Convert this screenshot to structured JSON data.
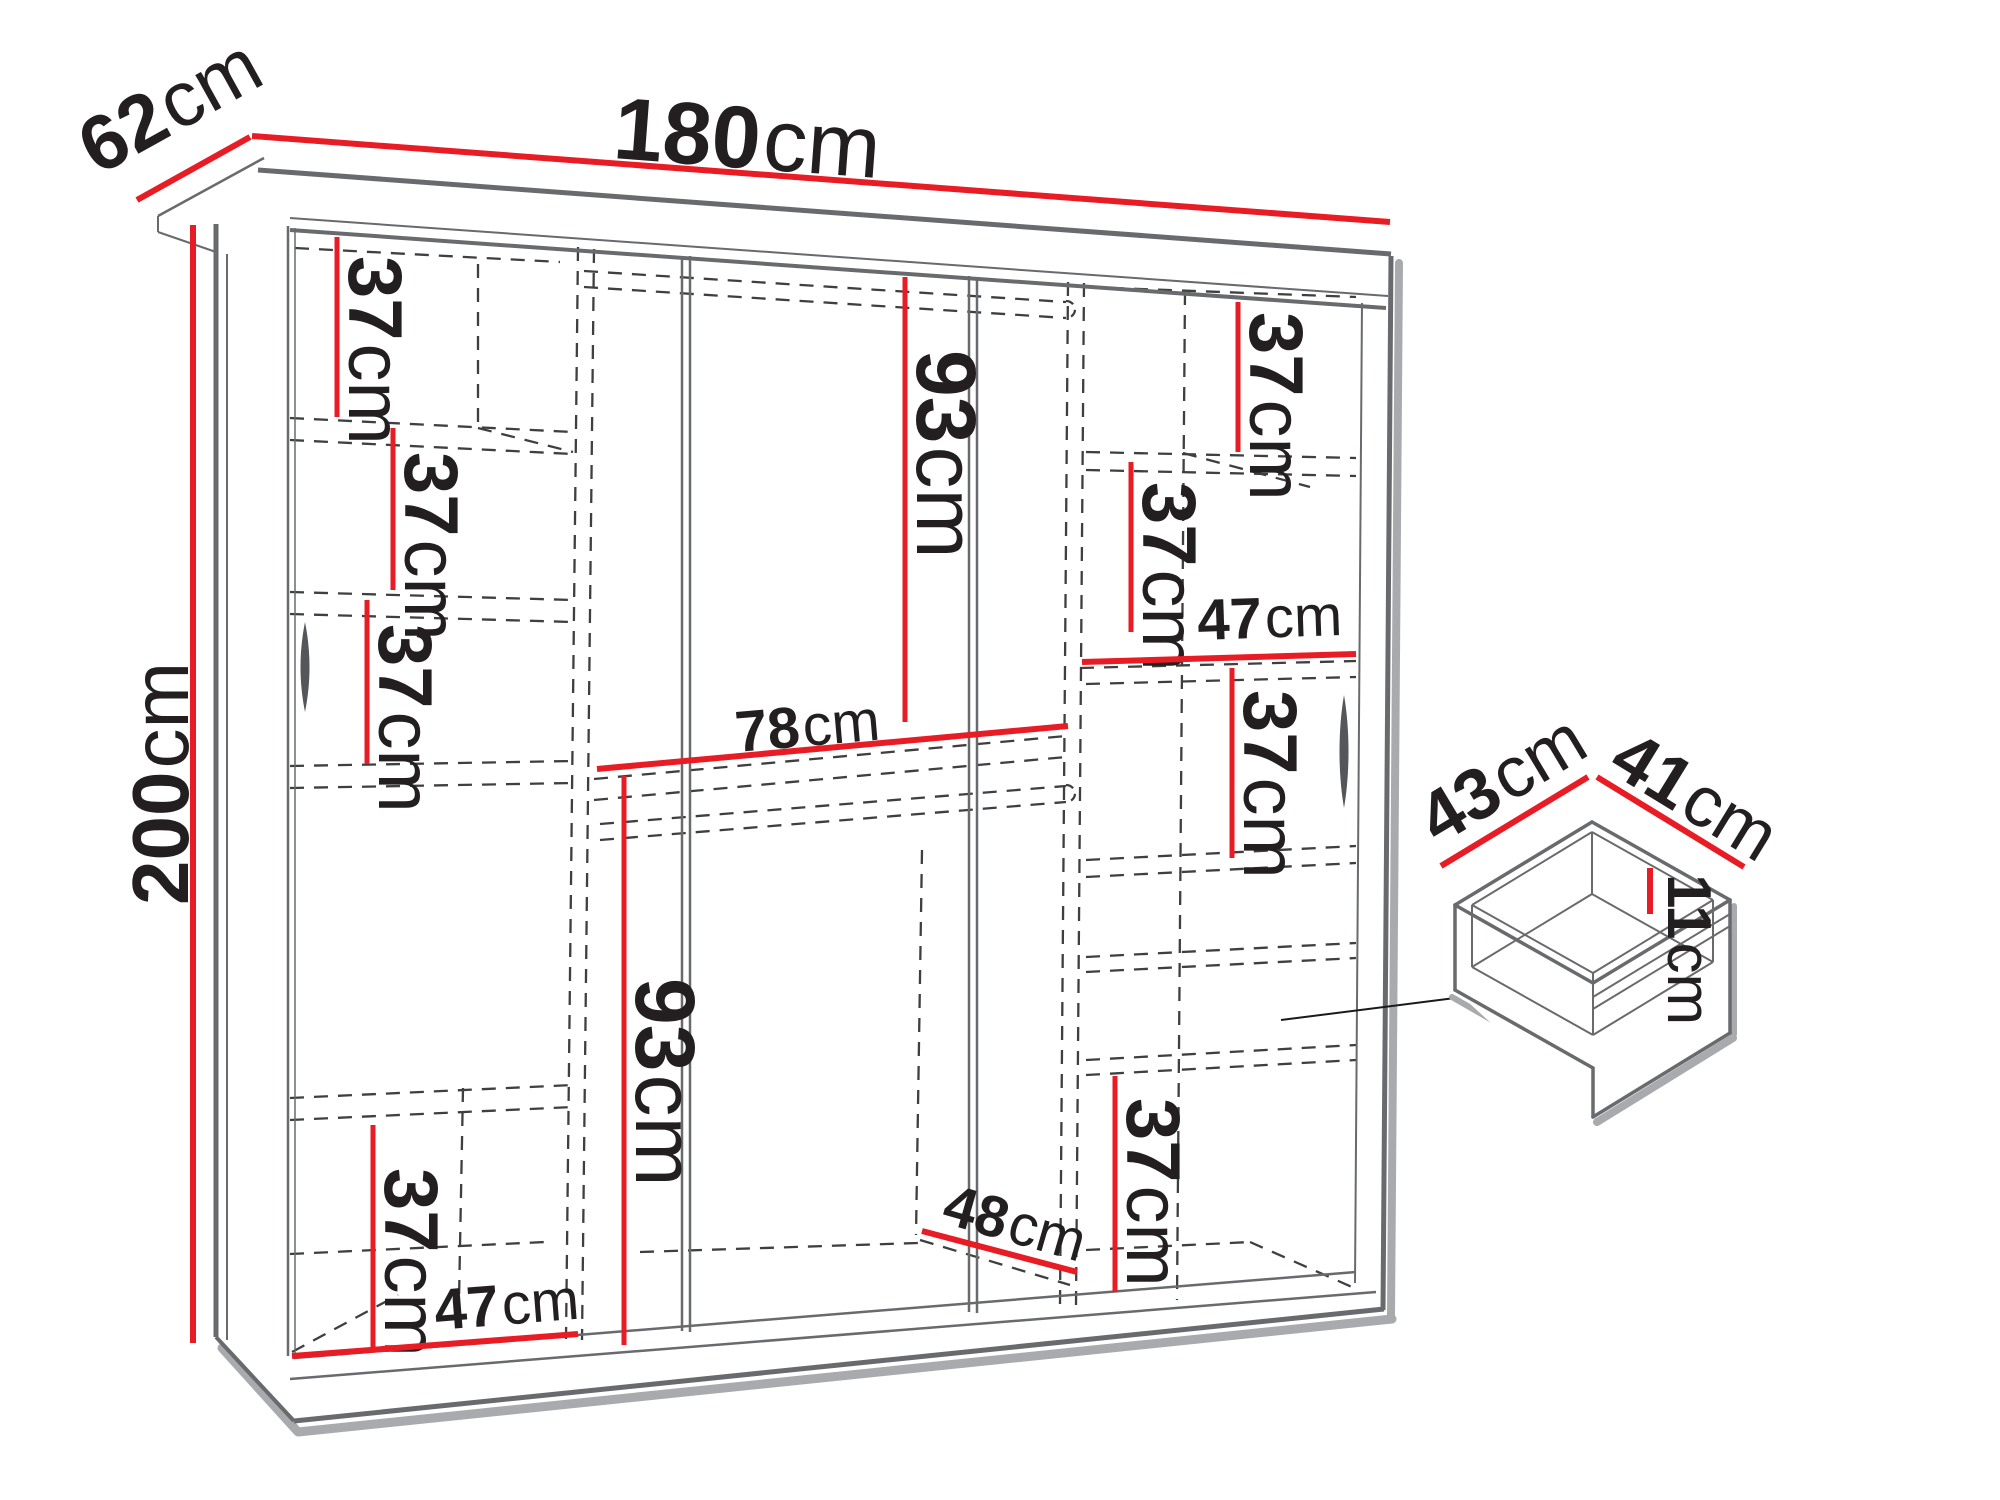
{
  "units": "cm",
  "colors": {
    "dimension_red": "#e81c24",
    "structure_gray": "#696a6d",
    "dash_dark": "#3f3f3f",
    "shadow_gray": "#a8aaad",
    "text_black": "#231f20",
    "background": "#ffffff"
  },
  "wardrobe": {
    "overall_dimensions": [
      {
        "id": "width",
        "value": "180",
        "unit": "cm",
        "line": [
          252,
          136,
          1390,
          222
        ],
        "width": 6,
        "label": {
          "x": 612,
          "y": 158,
          "rotate": 4.3,
          "size": 88
        }
      },
      {
        "id": "depth",
        "value": "62",
        "unit": "cm",
        "line": [
          137,
          200,
          250,
          137
        ],
        "width": 6,
        "label": {
          "x": 98,
          "y": 176,
          "rotate": -29,
          "size": 78
        }
      },
      {
        "id": "height",
        "value": "200",
        "unit": "cm",
        "line": [
          193,
          225,
          193,
          1343
        ],
        "width": 6,
        "label": {
          "x": 188,
          "y": 905,
          "rotate": -90,
          "size": 80
        }
      }
    ],
    "internal_dimensions": [
      {
        "id": "left-shelf-1",
        "value": "37",
        "unit": "cm",
        "line": [
          337,
          237,
          337,
          417
        ],
        "width": 5,
        "label": {
          "x": 349,
          "y": 256,
          "rotate": 90,
          "size": 76
        }
      },
      {
        "id": "left-shelf-2",
        "value": "37",
        "unit": "cm",
        "line": [
          393,
          428,
          393,
          590
        ],
        "width": 5,
        "label": {
          "x": 405,
          "y": 452,
          "rotate": 90,
          "size": 76
        }
      },
      {
        "id": "left-shelf-3",
        "value": "37",
        "unit": "cm",
        "line": [
          367,
          600,
          367,
          764
        ],
        "width": 5,
        "label": {
          "x": 379,
          "y": 624,
          "rotate": 90,
          "size": 76
        }
      },
      {
        "id": "left-shelf-bottom",
        "value": "37",
        "unit": "cm",
        "line": [
          373,
          1125,
          373,
          1347
        ],
        "width": 5,
        "label": {
          "x": 385,
          "y": 1168,
          "rotate": 90,
          "size": 76
        }
      },
      {
        "id": "left-width",
        "value": "47",
        "unit": "cm",
        "line": [
          292,
          1356,
          578,
          1334
        ],
        "width": 6,
        "label": {
          "x": 436,
          "y": 1330,
          "rotate": -4.5,
          "size": 58
        }
      },
      {
        "id": "middle-upper-height",
        "value": "93",
        "unit": "cm",
        "line": [
          905,
          277,
          905,
          722
        ],
        "width": 5,
        "label": {
          "x": 917,
          "y": 350,
          "rotate": 90,
          "size": 84
        }
      },
      {
        "id": "middle-width",
        "value": "78",
        "unit": "cm",
        "line": [
          597,
          769,
          1068,
          726
        ],
        "width": 6,
        "label": {
          "x": 737,
          "y": 752,
          "rotate": -5,
          "size": 58
        }
      },
      {
        "id": "middle-lower-height",
        "value": "93",
        "unit": "cm",
        "line": [
          624,
          776,
          624,
          1345
        ],
        "width": 5,
        "label": {
          "x": 636,
          "y": 978,
          "rotate": 90,
          "size": 84
        }
      },
      {
        "id": "middle-depth",
        "value": "48",
        "unit": "cm",
        "line": [
          922,
          1231,
          1077,
          1272
        ],
        "width": 6,
        "label": {
          "x": 940,
          "y": 1222,
          "rotate": 16,
          "size": 58
        }
      },
      {
        "id": "right-shelf-1",
        "value": "37",
        "unit": "cm",
        "line": [
          1238,
          302,
          1238,
          452
        ],
        "width": 5,
        "label": {
          "x": 1250,
          "y": 312,
          "rotate": 90,
          "size": 76
        }
      },
      {
        "id": "right-shelf-2",
        "value": "37",
        "unit": "cm",
        "line": [
          1131,
          462,
          1131,
          632
        ],
        "width": 5,
        "label": {
          "x": 1143,
          "y": 482,
          "rotate": 90,
          "size": 76
        }
      },
      {
        "id": "right-width",
        "value": "47",
        "unit": "cm",
        "line": [
          1082,
          662,
          1356,
          654
        ],
        "width": 6,
        "label": {
          "x": 1198,
          "y": 640,
          "rotate": -2,
          "size": 58
        }
      },
      {
        "id": "right-shelf-3",
        "value": "37",
        "unit": "cm",
        "line": [
          1232,
          668,
          1232,
          858
        ],
        "width": 5,
        "label": {
          "x": 1244,
          "y": 690,
          "rotate": 90,
          "size": 76
        }
      },
      {
        "id": "right-shelf-bottom",
        "value": "37",
        "unit": "cm",
        "line": [
          1115,
          1076,
          1115,
          1292
        ],
        "width": 5,
        "label": {
          "x": 1127,
          "y": 1098,
          "rotate": 90,
          "size": 76
        }
      }
    ]
  },
  "drawer_detail": {
    "dimensions": [
      {
        "id": "drawer-width",
        "value": "43",
        "unit": "cm",
        "line": [
          1441,
          866,
          1588,
          777
        ],
        "width": 6,
        "label": {
          "x": 1438,
          "y": 846,
          "rotate": -31,
          "size": 72
        }
      },
      {
        "id": "drawer-depth",
        "value": "41",
        "unit": "cm",
        "line": [
          1597,
          777,
          1744,
          867
        ],
        "width": 6,
        "label": {
          "x": 1606,
          "y": 770,
          "rotate": 31.5,
          "size": 72
        }
      },
      {
        "id": "drawer-height",
        "value": "11",
        "unit": "cm",
        "line": [
          1650,
          868,
          1650,
          914
        ],
        "width": 6,
        "label": {
          "x": 1668,
          "y": 874,
          "rotate": 90,
          "size": 62
        }
      }
    ]
  }
}
